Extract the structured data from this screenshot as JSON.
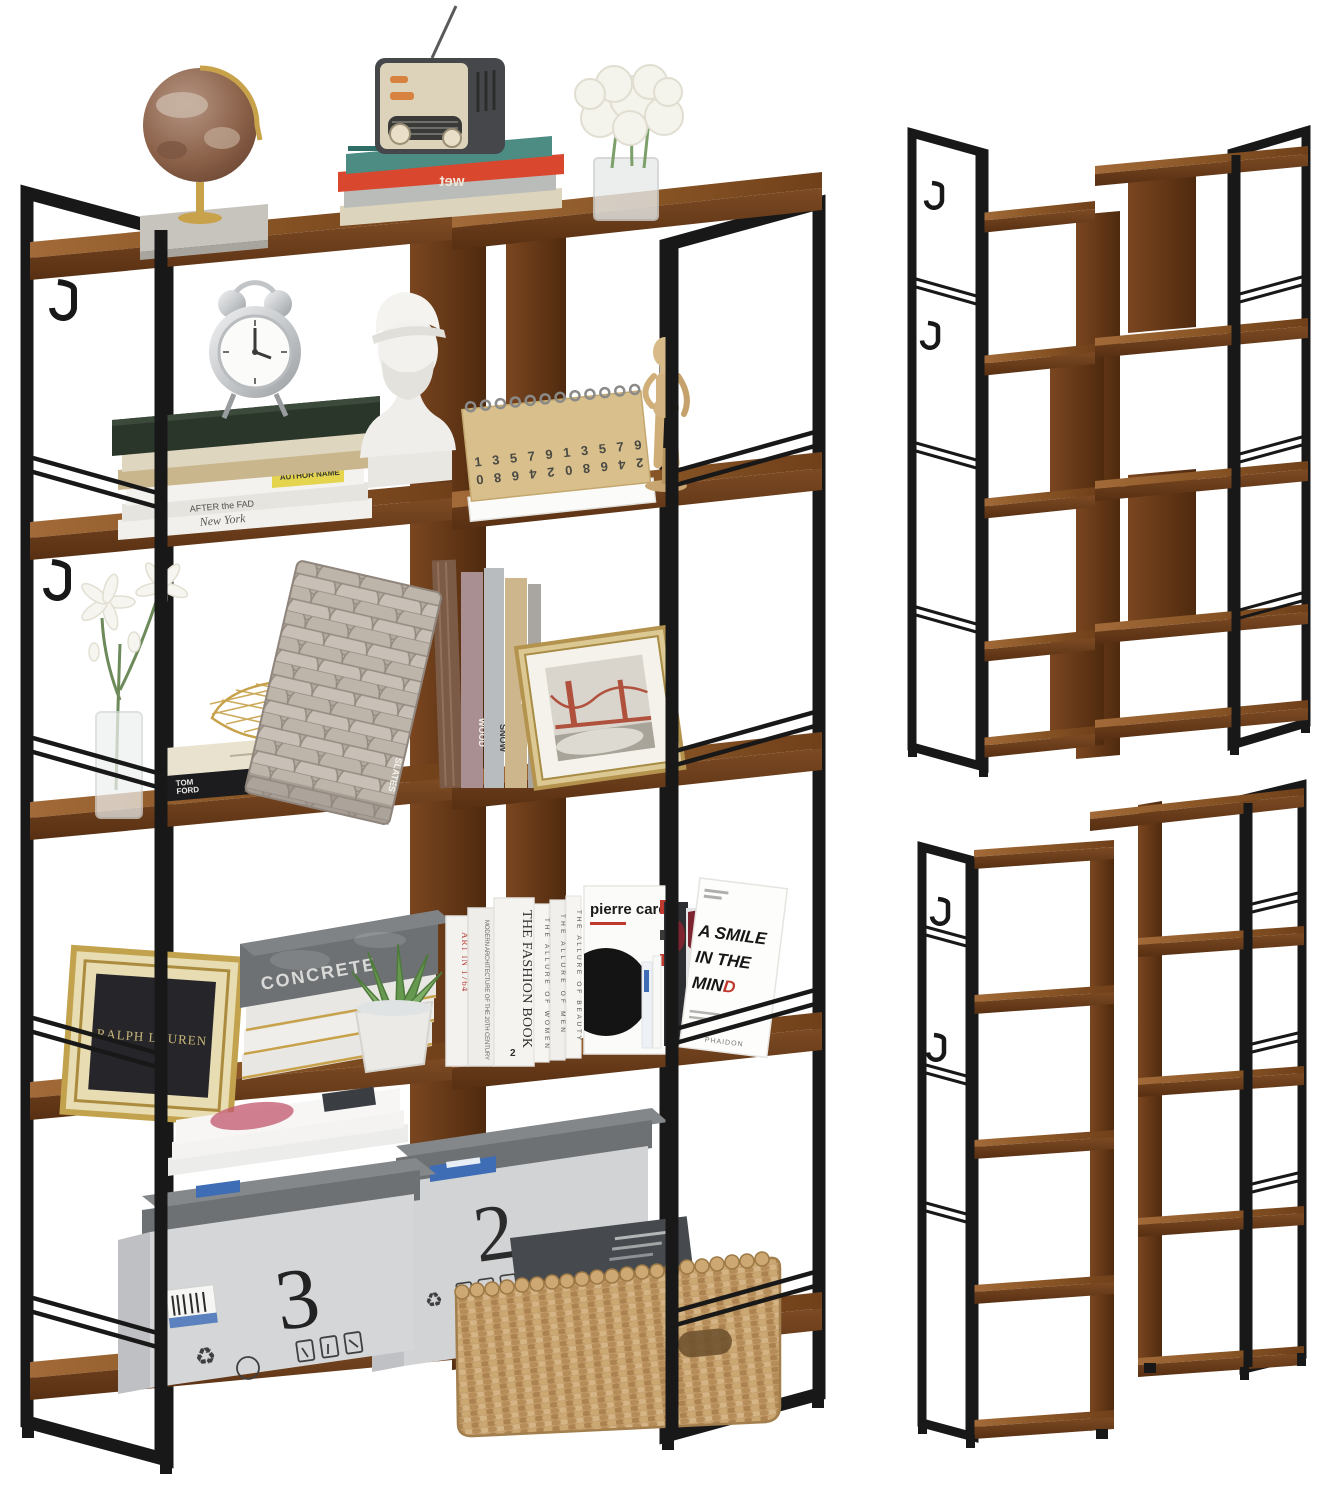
{
  "scene": {
    "background": "#ffffff",
    "subject": "industrial corner bookshelf product photo, three views"
  },
  "palette": {
    "wood": "#7c4a23",
    "wood_light": "#9a6434",
    "wood_dark": "#573013",
    "metal_black": "#181818",
    "gold": "#c8a24b",
    "box_gray": "#d3d4d6",
    "lid_gray": "#75787b",
    "basket_tan": "#c49e6c",
    "accent_red": "#c0392e",
    "teal_book": "#4d8c83",
    "plant_green": "#61954f"
  },
  "decor": {
    "radio_books": {
      "red_spine": "wet"
    },
    "clock_books": {
      "spine_after": "AFTER the FAD",
      "spine_newyork": "New York",
      "label": "AUTHOR NAME"
    },
    "calendar": {
      "row1": "1 3 5 7 9 1 3 5 7 9",
      "row2": "2 4 6 8 0 2 4 6 8 0"
    },
    "tray_book": {
      "line1": "TOM",
      "line2": "FORD"
    },
    "texture_books": {
      "slates": "SLATES",
      "wood": "WOOD",
      "snow": "SNOW",
      "sandstone": "SANDSTONE"
    },
    "ralph_frame": {
      "brand": "RALPH LAUREN"
    },
    "concrete_stack": {
      "title": "CONCRETE"
    },
    "magazines": {
      "spine_art": "ART IN 1764",
      "spine_architecture": "MODERN ARCHITECTURE OF THE 20TH CENTURY",
      "spine_fashion": "THE FASHION BOOK",
      "spine_fashion_number": "2",
      "spine_allure_women": "THE ALLURE OF WOMEN",
      "spine_allure_men": "THE ALLURE OF MEN",
      "spine_allure_beauty": "THE ALLURE OF BEAUTY",
      "cover_pierre": "pierre cardin",
      "smile_line1": "A SMILE",
      "smile_line2": "IN THE",
      "smile_line3a": "MIN",
      "smile_line3b": "D",
      "smile_publisher": "PHAIDON"
    },
    "boxes": {
      "left_number": "3",
      "right_number": "2",
      "recycle_glyph": "♻"
    }
  }
}
